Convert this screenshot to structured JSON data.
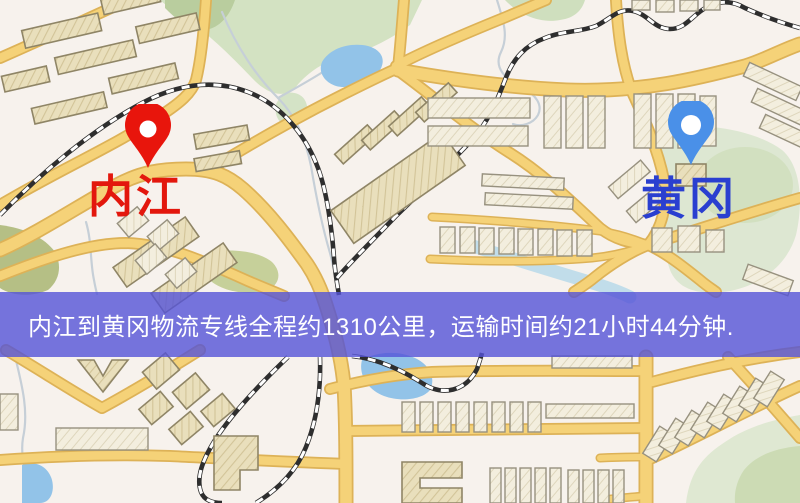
{
  "map": {
    "origin": {
      "label": "内江",
      "pin_color": "#e8150c",
      "label_color": "#e3170d"
    },
    "destination": {
      "label": "黄冈",
      "pin_color": "#4a90e8",
      "label_color": "#2a3fd0"
    }
  },
  "banner": {
    "text": "内江到黄冈物流专线全程约1310公里，运输时间约21小时44分钟.",
    "distance_km": "1310",
    "duration": "21小时44分钟",
    "background_color": "#5453d7",
    "text_color": "#ffffff"
  },
  "palette": {
    "map_background": "#f7f2ed",
    "road_fill": "#f5d278",
    "road_casing": "#ddb257",
    "park_green": "#d3e2c2",
    "olive_green": "#b5bd82",
    "water_blue": "#92c3e8",
    "railway_black": "#2e2e2e",
    "building_beige": "#e9dfbc"
  }
}
